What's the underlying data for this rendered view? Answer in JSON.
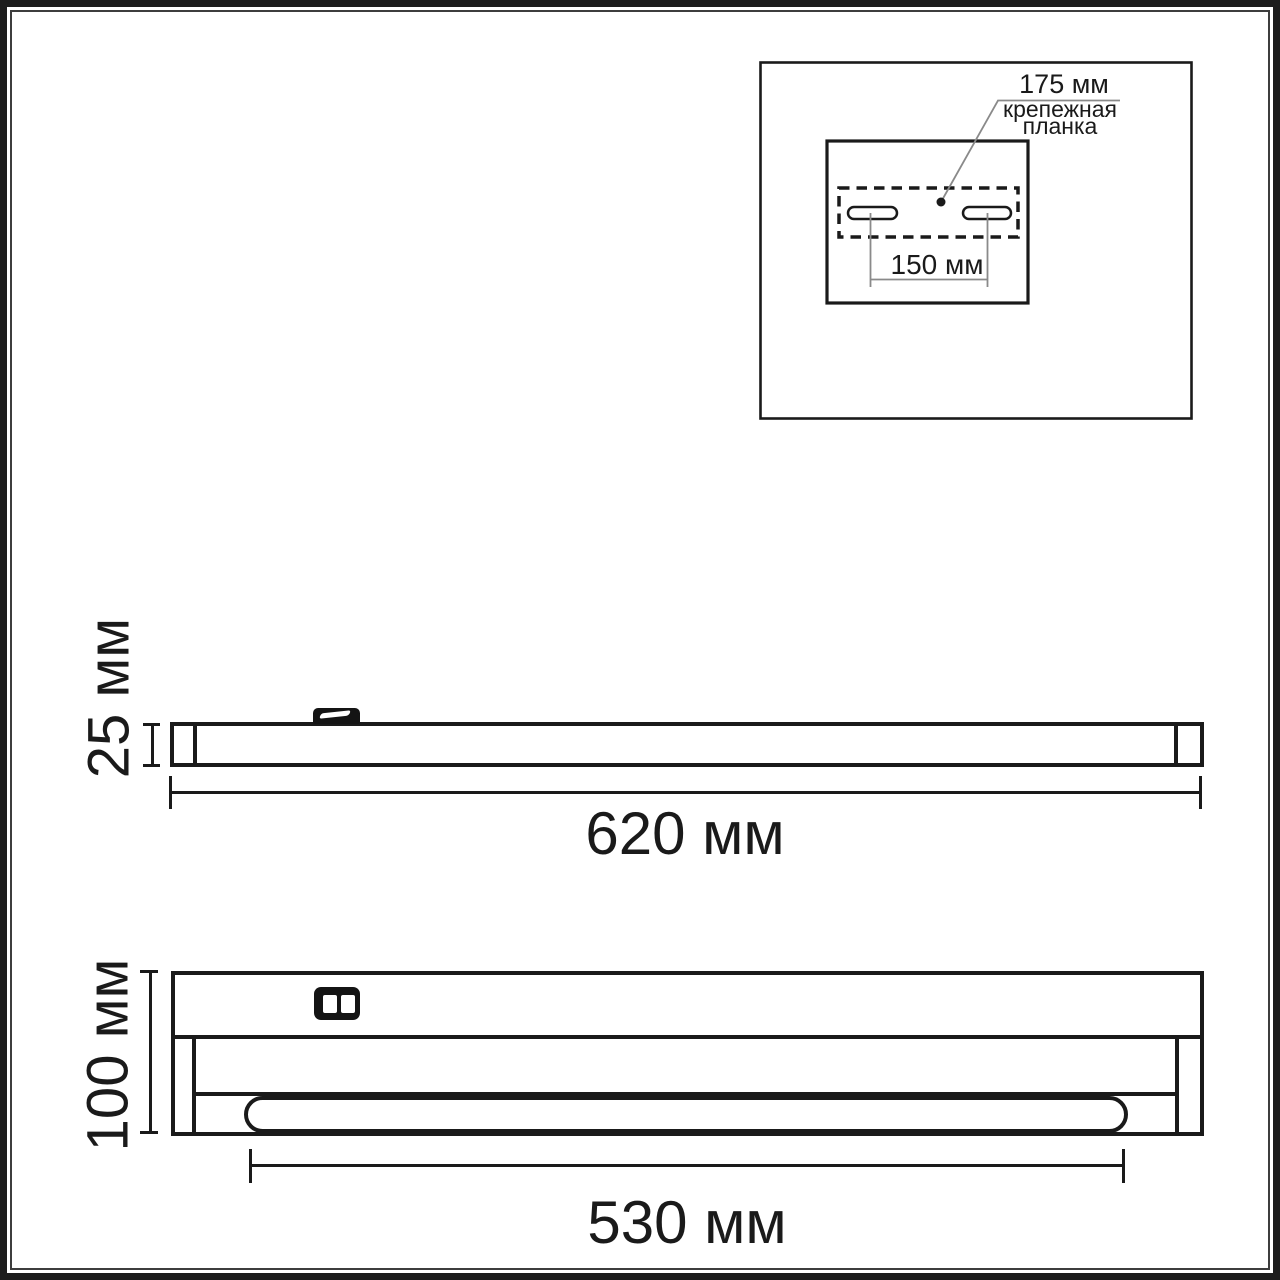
{
  "drawing": {
    "background": "#ffffff",
    "line_color": "#1a1a1a",
    "guide_color": "#8a8a8a"
  },
  "inset": {
    "offset_label": "175 мм",
    "bracket_label_line1": "крепежная",
    "bracket_label_line2": "планка",
    "slot_spacing_label": "150 мм"
  },
  "side_view": {
    "height_label": "25 мм",
    "length_label": "620 мм"
  },
  "front_view": {
    "height_label": "100 мм",
    "lamp_length_label": "530 мм"
  }
}
